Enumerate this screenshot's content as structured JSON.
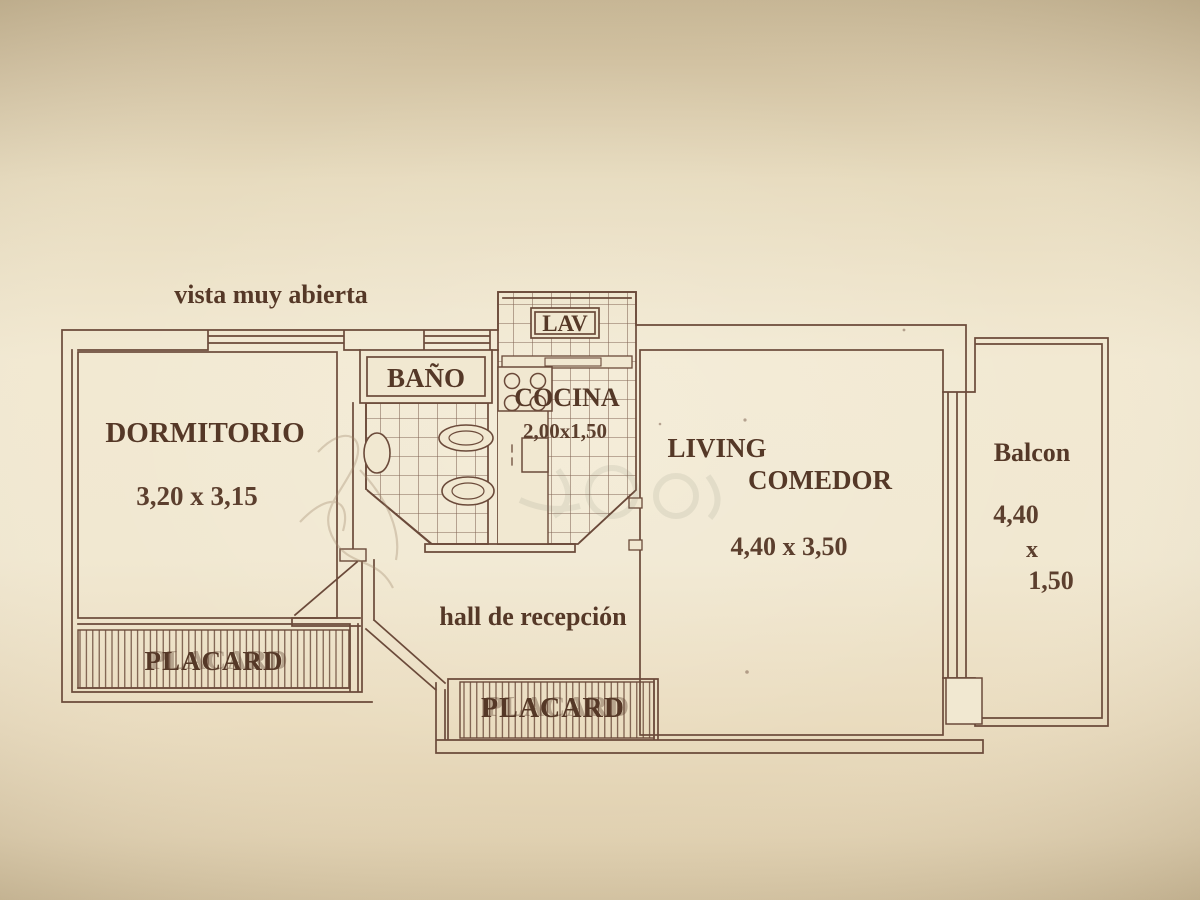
{
  "plan": {
    "note": "vista muy abierta",
    "dormitorio_label": "DORMITORIO",
    "dormitorio_dims": "3,20 x 3,15",
    "bano_label": "BAÑO",
    "lav_label": "LAV",
    "cocina_label": "COCINA",
    "cocina_dims": "2,00x1,50",
    "living_label_1": "LIVING",
    "living_label_2": "COMEDOR",
    "living_dims": "4,40 x 3,50",
    "balcon_label": "Balcon",
    "balcon_dim_w": "4,40",
    "balcon_dim_sep": "x",
    "balcon_dim_d": "1,50",
    "hall_label": "hall de recepción",
    "placard_dorm_label": "PLACARD",
    "placard_hall_label": "PLACARD"
  },
  "colors": {
    "paper_light": "#f2e9d2",
    "paper_dark": "#cdbd9f",
    "ink_line": "#6b4a3a",
    "ink_text": "#553827",
    "watermark": "#7e8370"
  }
}
